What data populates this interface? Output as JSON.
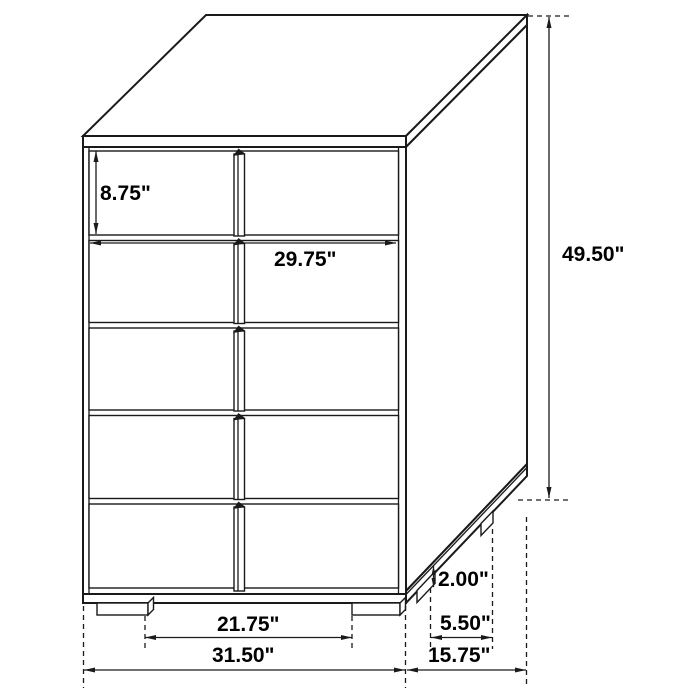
{
  "diagram": {
    "type": "furniture-dimension-line-drawing",
    "subject": "five-drawer-chest",
    "unit": "inches",
    "drawer_rows_visible": 5,
    "colors": {
      "line": "#1a1a1a",
      "text": "#000000",
      "background": "#ffffff"
    },
    "labels": {
      "top_drawer_height": "8.75\"",
      "drawer_width": "29.75\"",
      "overall_height": "49.50\"",
      "foot_height": "2.00\"",
      "foot_inset_depth": "5.50\"",
      "foot_spacing_width": "21.75\"",
      "overall_width": "31.50\"",
      "overall_depth": "15.75\""
    }
  }
}
